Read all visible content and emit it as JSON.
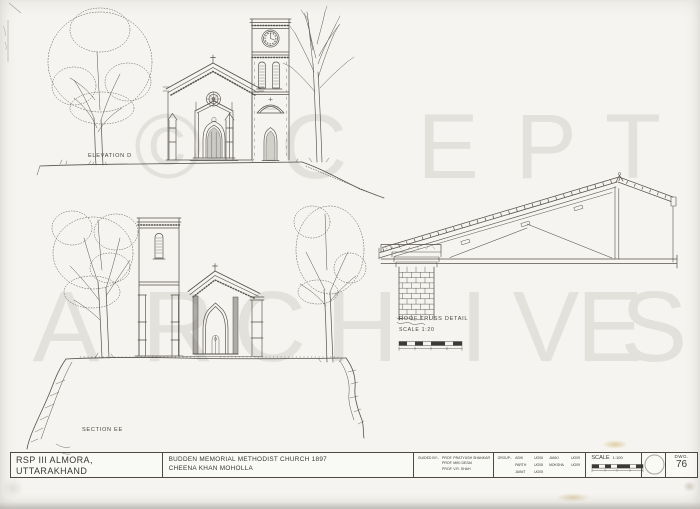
{
  "colors": {
    "paper": "#f6f4f0",
    "ink": "#3a3834",
    "line": "#55524c",
    "watermark": "#e3e1dc"
  },
  "watermark": {
    "line1": [
      "©",
      "C",
      "E",
      "P",
      "T"
    ],
    "line2": [
      "A",
      "R",
      "C",
      "H",
      "I",
      "V",
      "E",
      "S"
    ]
  },
  "labels": {
    "elevation": "ELEVATION D",
    "section": "SECTION EE",
    "truss_title": "ROOF TRUSS DETAIL",
    "truss_scale": "SCALE 1:20"
  },
  "title_block": {
    "project_code": "RSP III  ALMORA, UTTARAKHAND",
    "date": "NOV.  2010",
    "drawing_title": "BUDDEN MEMORIAL METHODIST CHURCH 1897",
    "location": "CHEENA KHAN MOHOLLA",
    "guided_by_label": "GUIDED BY:-",
    "guides": [
      "PROF. PRATYUSH SHANKAR",
      "PROF. MIKI DESAI",
      "PROF. V.R. SHAH"
    ],
    "group_label": "GROUP:-",
    "group_rows": [
      [
        "ASHI",
        "UG06",
        "JANKI",
        "UG09"
      ],
      [
        "PARTH",
        "UG08",
        "MOKSHA",
        "UG09"
      ],
      [
        "JAINIT",
        "UG05",
        "",
        ""
      ]
    ],
    "scale_label": "SCALE",
    "scale_value": "1:100",
    "dwg_label": "DWG.",
    "dwg_number": "76"
  }
}
